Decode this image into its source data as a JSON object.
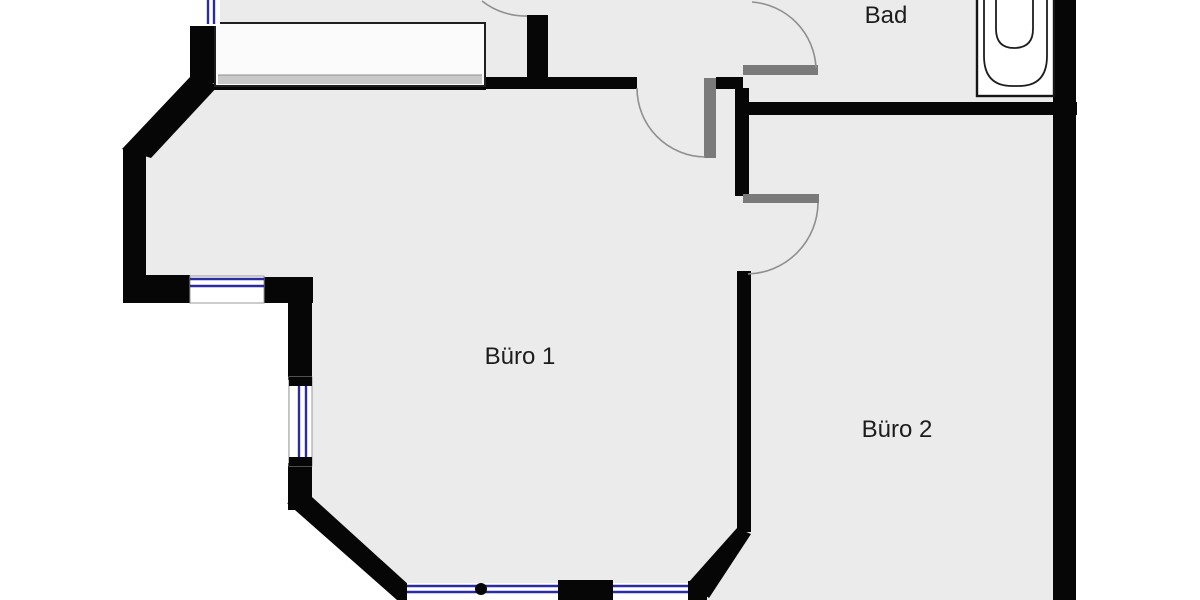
{
  "plan": {
    "title": "floor-plan",
    "rooms": [
      {
        "id": "bad",
        "label": "Bad",
        "fixtures": [
          "bathtub-icon"
        ]
      },
      {
        "id": "buero1",
        "label": "Büro 1",
        "fixtures": [
          "closet",
          "window-bay"
        ]
      },
      {
        "id": "buero2",
        "label": "Büro 2",
        "fixtures": []
      }
    ],
    "colors": {
      "wall": "#060606",
      "floor": "#ebebeb",
      "exterior": "#ffffff",
      "window_blue": "#2b2ba3",
      "door_leaf": "#7a7a7a",
      "door_arc": "#8f8f8f",
      "closet_fill": "#fbfbfb",
      "closet_band": "#c9c9c9",
      "label_text": "#1c1c1c"
    }
  }
}
